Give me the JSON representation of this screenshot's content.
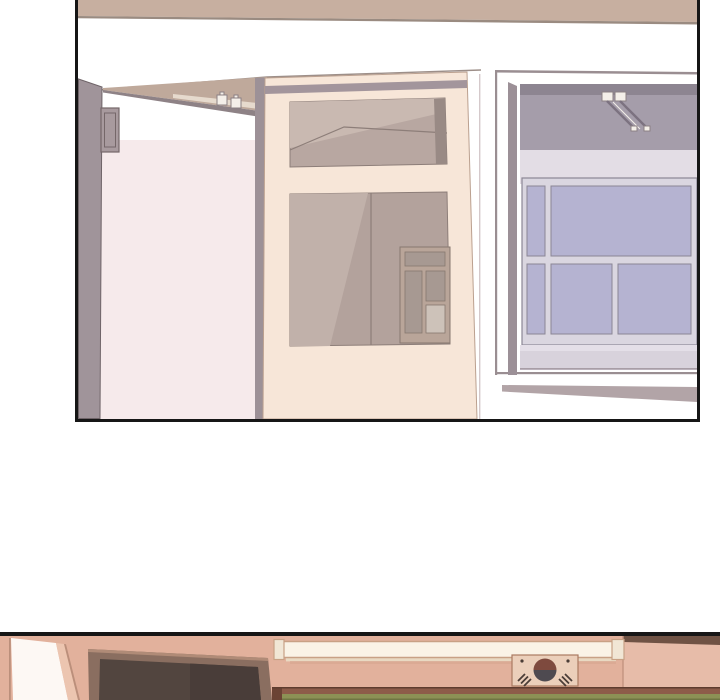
{
  "page": {
    "type": "webtoon-comic-page",
    "text_content": "none (wordless illustration panels)",
    "panel_count_visible": 2
  },
  "panels": [
    {
      "id": "panel-1",
      "description": "Interior hallway: open sliding-door pocket with track rollers, a cream glazed wooden door with transom window, and a lavender sash window seen through a wall opening",
      "objects": [
        "ceiling-beam",
        "open-doorway-jamb",
        "electrical-box",
        "door-track-rollers",
        "glazed-door",
        "transom-window",
        "door-lower-glass",
        "interior-window",
        "wall-opening-frame",
        "sash-window",
        "window-sill"
      ]
    },
    {
      "id": "panel-2",
      "description": "Top of a classroom front wall: open door at left, wall-mounted TV, fluorescent light fixture, Korean flag plaque, and chalkboard top edge",
      "objects": [
        "open-door",
        "tv-monitor",
        "fluorescent-light",
        "korean-flag-plaque",
        "chalkboard"
      ]
    }
  ],
  "colors": {
    "panel_border": "#161616",
    "page_bg": "#ffffff",
    "beam_tan": "#c7afa0",
    "beam_edge": "#9a8b81",
    "line_dark": "#9d8f89",
    "jamb_gray": "#a0949a",
    "jamb_edge": "#6f6468",
    "box_fill": "#a89a9e",
    "box_edge": "#756769",
    "pink_wall": "#f6eaeb",
    "wedge_tan": "#bfa99b",
    "wedge_gray": "#8e8286",
    "rail_light": "#e6dacd",
    "roller_white": "#f4efe9",
    "roller_edge": "#8b8084",
    "pocket_gray": "#9d9197",
    "door_cream": "#f7e6d8",
    "door_edge": "#bba08f",
    "door_track": "#a3959c",
    "glass_base": "#b8a7a1",
    "glass_base2": "#b3a29c",
    "glass_light": "#c9b9b1",
    "glass_light2": "#c1b1aa",
    "glass_dark": "#998a85",
    "glass_line": "#8d7e79",
    "int_frame": "#b9a599",
    "int_pane": "#a79992",
    "int_pane_light": "#cdc2b9",
    "int_line": "#87786f",
    "hairline": "#d5c9cb",
    "frame_line": "#9a8e92",
    "reveal_gray": "#9c9097",
    "ceiling_gray": "#a59daa",
    "ceiling_dark": "#8d8591",
    "rail_dark": "#7c7280",
    "lavender_wall": "#e3dde5",
    "win_frame": "#dad6e0",
    "win_mullion": "#8b8695",
    "win_glass": "#b5b3d1",
    "sill_light": "#e4dfe8",
    "sill": "#d8d2dc",
    "sill_line": "#a89da6",
    "ext_sill": "#b2a4a7",
    "p2_wall": "#e2b19c",
    "p2_wall_right": "#e7bca9",
    "p2_dark_beam": "#6f5244",
    "p2_corner_line": "#c49480",
    "p2_door_white": "#fdf8f4",
    "p2_door_frame": "#ecc5b0",
    "p2_door_line": "#bb8f7b",
    "tv_bezel": "#8a6e60",
    "tv_bezel_top": "#b08b77",
    "tv_screen": "#52453f",
    "tv_screen_dark": "#493d39",
    "light_fill": "#faf3e6",
    "light_cap": "#f1e6d5",
    "light_stroke": "#c8a185",
    "light_shade": "#e9d9c2",
    "wall_shadow": "#d6a48e",
    "flag_bg": "#ebcfba",
    "flag_edge": "#aa7a62",
    "taeguk_red": "#7e4a3e",
    "taeguk_blue": "#4e4a50",
    "trigram": "#4a3d36",
    "board_frame": "#8d5c49",
    "board_frame_dark": "#5e3c2e",
    "board_edge": "#6b4334",
    "board_green": "#8c9155",
    "board_green_dark": "#6f7542"
  }
}
